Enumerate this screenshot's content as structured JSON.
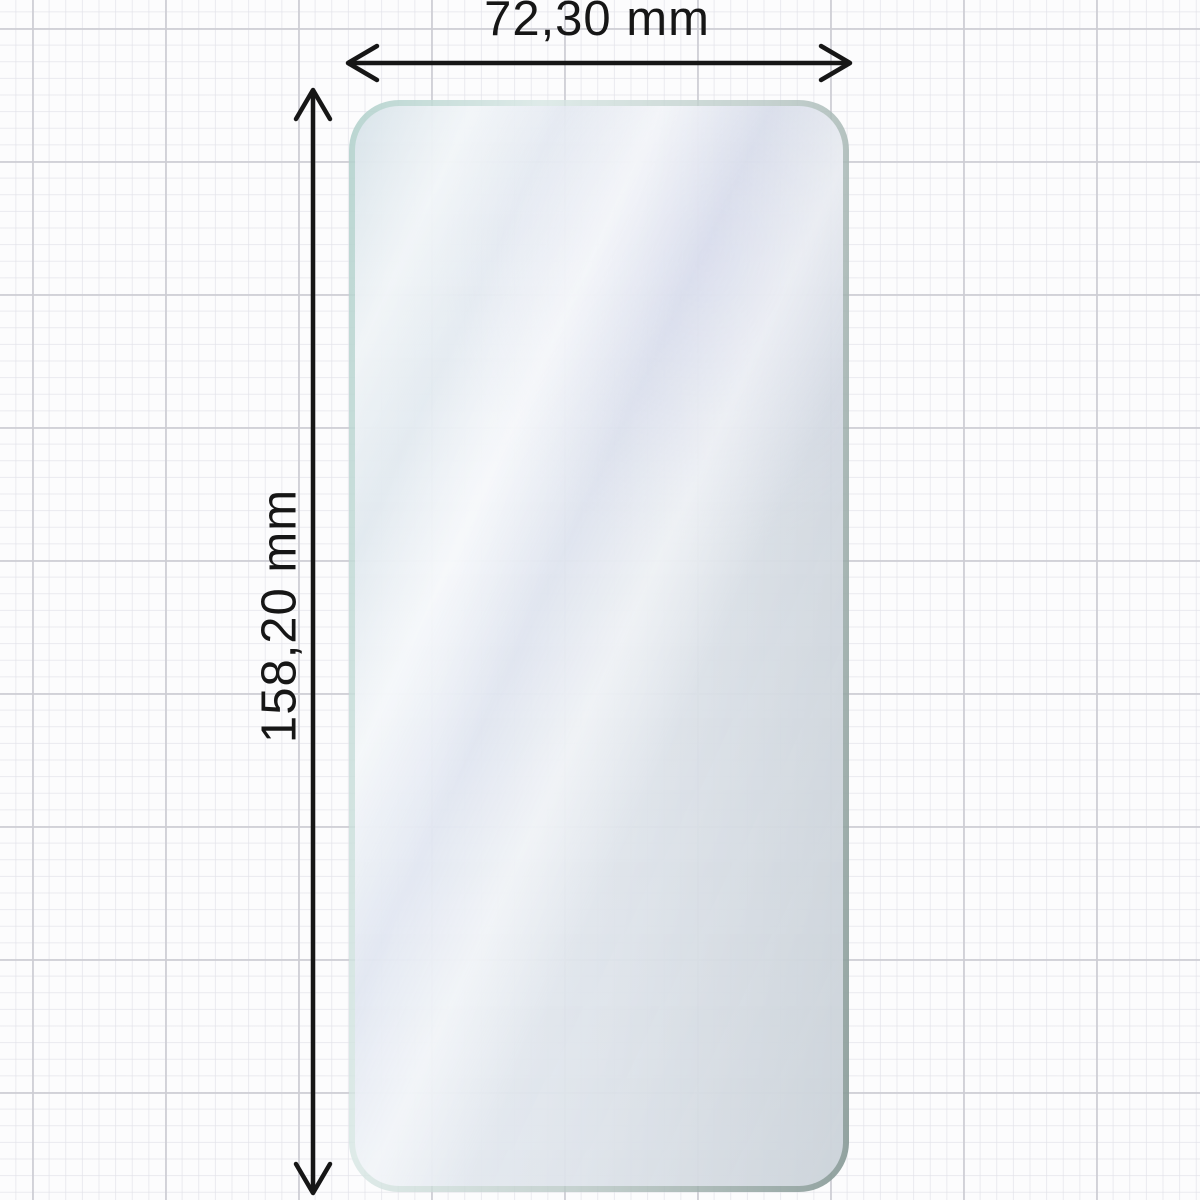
{
  "diagram": {
    "type": "product-dimension-diagram",
    "subject": "phone screen protector film on graph paper",
    "width_label": "72,30 mm",
    "height_label": "158,20 mm",
    "unit": "mm",
    "colors": {
      "annotation": "#161616",
      "canvas_background": "#fcfcfd",
      "grid_minor": "#e2e2e9",
      "grid_major": "#cdcdd4",
      "film_edge_teal": "#b2d1cc",
      "film_edge_gray": "#889a97",
      "film_tint_lavender": "#e9ebf6",
      "film_sheen": "#ffffff"
    },
    "icons": [
      {
        "name": "width-dimension-arrow",
        "meaning": "double-headed horizontal measuring arrow"
      },
      {
        "name": "height-dimension-arrow",
        "meaning": "double-headed vertical measuring arrow"
      }
    ]
  }
}
